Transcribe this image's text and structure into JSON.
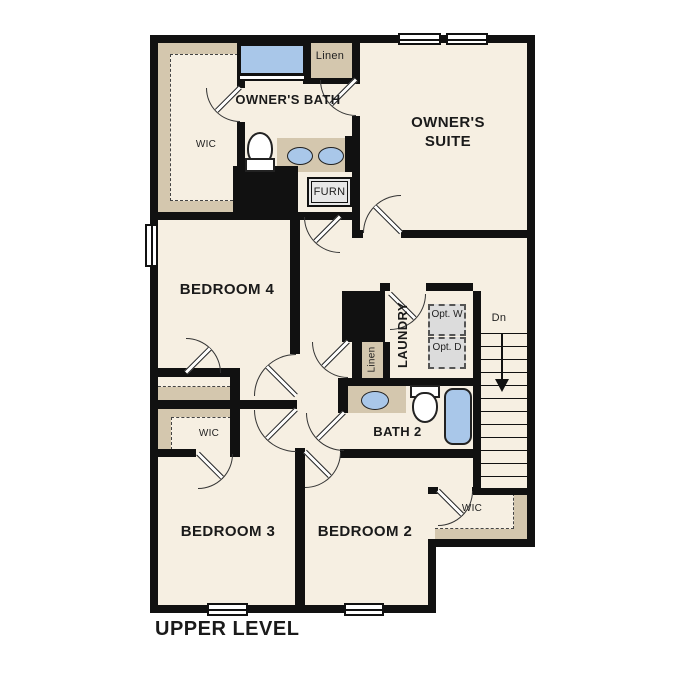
{
  "plan": {
    "title": "UPPER LEVEL"
  },
  "rooms": {
    "owners_suite": "OWNER'S SUITE",
    "owners_bath": "OWNER'S BATH",
    "bedroom4": "BEDROOM 4",
    "bedroom3": "BEDROOM 3",
    "bedroom2": "BEDROOM 2",
    "bath2": "BATH 2",
    "laundry": "LAUNDRY",
    "wic_owner": "WIC",
    "wic_bed3": "WIC",
    "wic_bed2": "WIC",
    "linen_upper": "Linen",
    "linen_hall": "Linen",
    "furnace": "FURN"
  },
  "laundry_options": {
    "washer": "Opt. W",
    "dryer": "Opt. D"
  },
  "stairs": {
    "label": "Dn",
    "treads": 12
  },
  "colors": {
    "floor": "#f6efe2",
    "shelf": "#d4c7ae",
    "wall": "#111111",
    "fixture_blue": "#a9c7e9",
    "option_gray": "#dcdcdc"
  }
}
